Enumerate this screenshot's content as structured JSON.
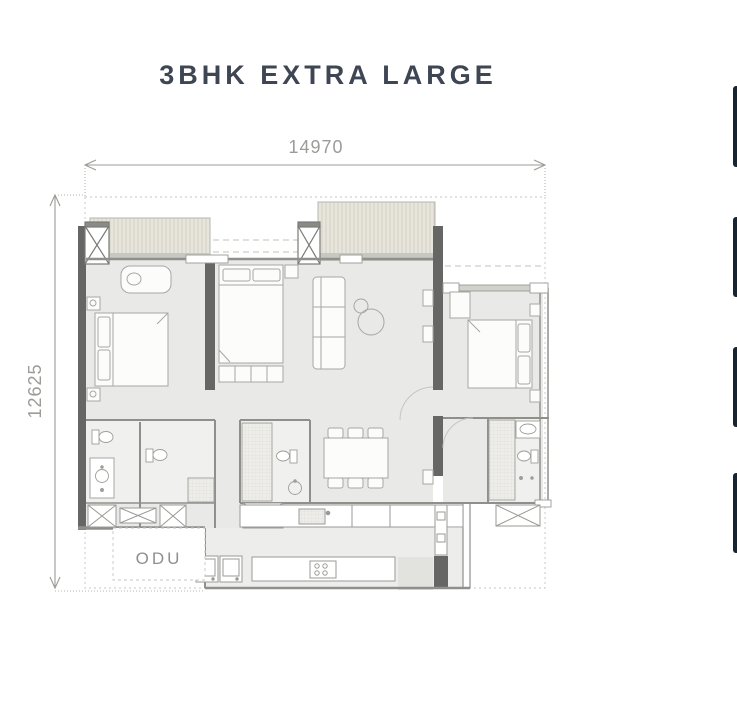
{
  "floor_plan": {
    "title": "3BHK EXTRA LARGE",
    "dimensions": {
      "width_label": "14970",
      "height_label": "12625"
    },
    "labels": {
      "odu": "ODU"
    },
    "colors": {
      "title": "#3f4653",
      "dimension": "#9b9b97",
      "wall_dark": "#666664",
      "interior_fill": "#e9e9e7",
      "balcony_fill": "#e7e5dc",
      "boundary": "#c4c4be",
      "odu_text": "#8f8f8b"
    }
  },
  "right_edge": {
    "stub_count": 4,
    "color": "#18242f"
  }
}
